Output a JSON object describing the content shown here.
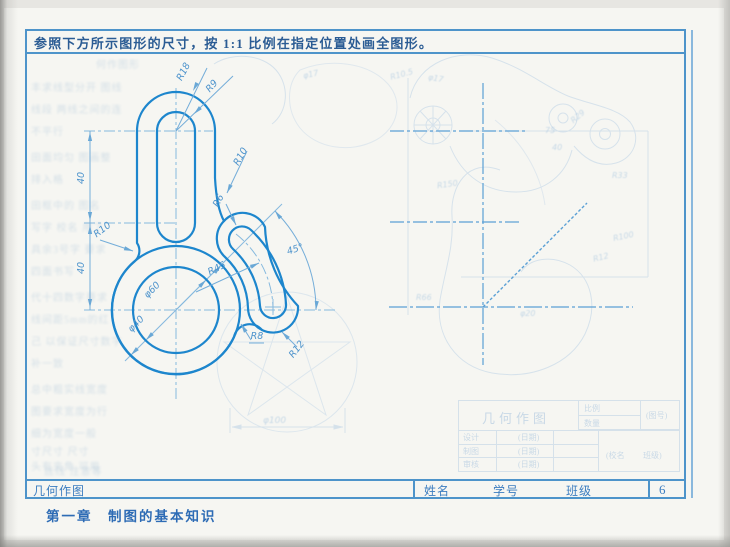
{
  "page": {
    "instruction": "参照下方所示图形的尺寸，按 1:1 比例在指定位置处画全图形。",
    "chapter": "第一章　制图的基本知识",
    "footer": {
      "title_cell": "几何作图",
      "name_label": "姓名",
      "student_id_label": "学号",
      "class_label": "班级",
      "page_number": "6"
    }
  },
  "drawing": {
    "dims": {
      "r18": "R18",
      "r9": "R9",
      "r10_left": "R10",
      "r10_right": "R10",
      "r6": "R6",
      "r45": "R45",
      "r8": "R8",
      "r12": "R12",
      "angle45": "45°",
      "d60": "φ60",
      "d40": "φ40",
      "len_top": "40",
      "len_bottom": "40"
    }
  },
  "showthrough": {
    "labels": {
      "d17a": "φ17",
      "r105": "R10.5",
      "d17b": "φ17",
      "n75": "75",
      "n40": "40",
      "r29": "R29",
      "r33": "R33",
      "r150": "R150",
      "r100": "R100",
      "r12": "R12",
      "r66": "R66",
      "d20": "φ20",
      "d100": "φ100"
    },
    "titleblock": {
      "title": "几何作图",
      "scale": "比例",
      "qty": "数量",
      "fig_no": "(图号)",
      "design": "设计",
      "draft": "制图",
      "check": "审核",
      "date1": "(日期)",
      "date2": "(日期)",
      "date3": "(日期)",
      "school": "(校名",
      "cls": "班级)"
    },
    "left_lines": [
      "何作图形",
      "丰求线型分开 图线",
      "线段 两线之间的连",
      "不平行",
      "田面均匀 图画整",
      "排入格",
      "田框中的 图名",
      "写字 校名 用了",
      "具余3号字 要求",
      "四面书写",
      "代十四数字要求",
      "线间距5mm的红",
      "己 以保证尺寸数字",
      "补一致",
      "总中粗实线宽度",
      "图要求宽度为行",
      "细为宽度一般",
      "寸尺寸 尺寸",
      "头有夹角 可用",
      "丝线 注意等"
    ]
  },
  "colors": {
    "frame": "#4e94ca",
    "outline": "#1d86cd",
    "dimension": "#74add9",
    "dim_text": "#4d93cc",
    "centerline": "#86b9de",
    "construction": "#5ba0d5",
    "instruction_text": "#2b5c94",
    "footer_text": "#3c7dc0"
  }
}
